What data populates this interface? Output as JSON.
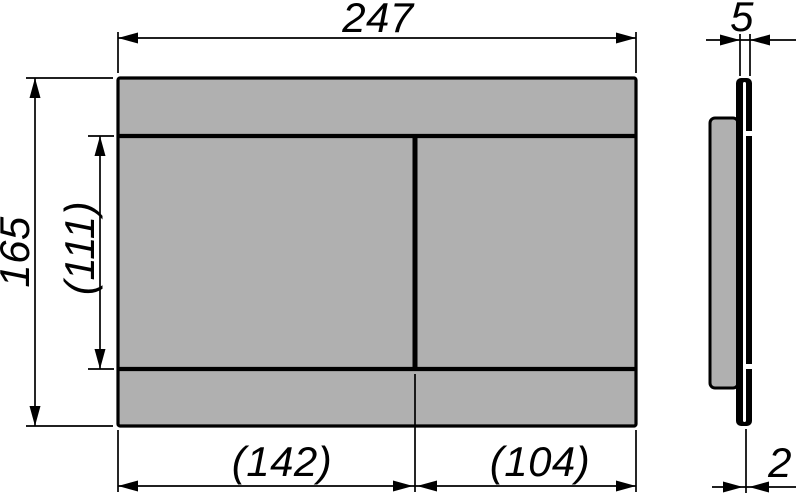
{
  "drawing": {
    "type": "technical-dimension-drawing",
    "subject": "flush-plate-front-and-side-view",
    "colors": {
      "line": "#000000",
      "panel_fill": "#b0b0b0",
      "highlight": "#ffffff",
      "background": "#ffffff"
    },
    "dimensions": {
      "total_width": "247",
      "total_height": "165",
      "buttons_height": "(111)",
      "left_button_width": "(142)",
      "right_button_width": "(104)",
      "plate_thickness": "5",
      "rim_thickness": "2"
    }
  }
}
